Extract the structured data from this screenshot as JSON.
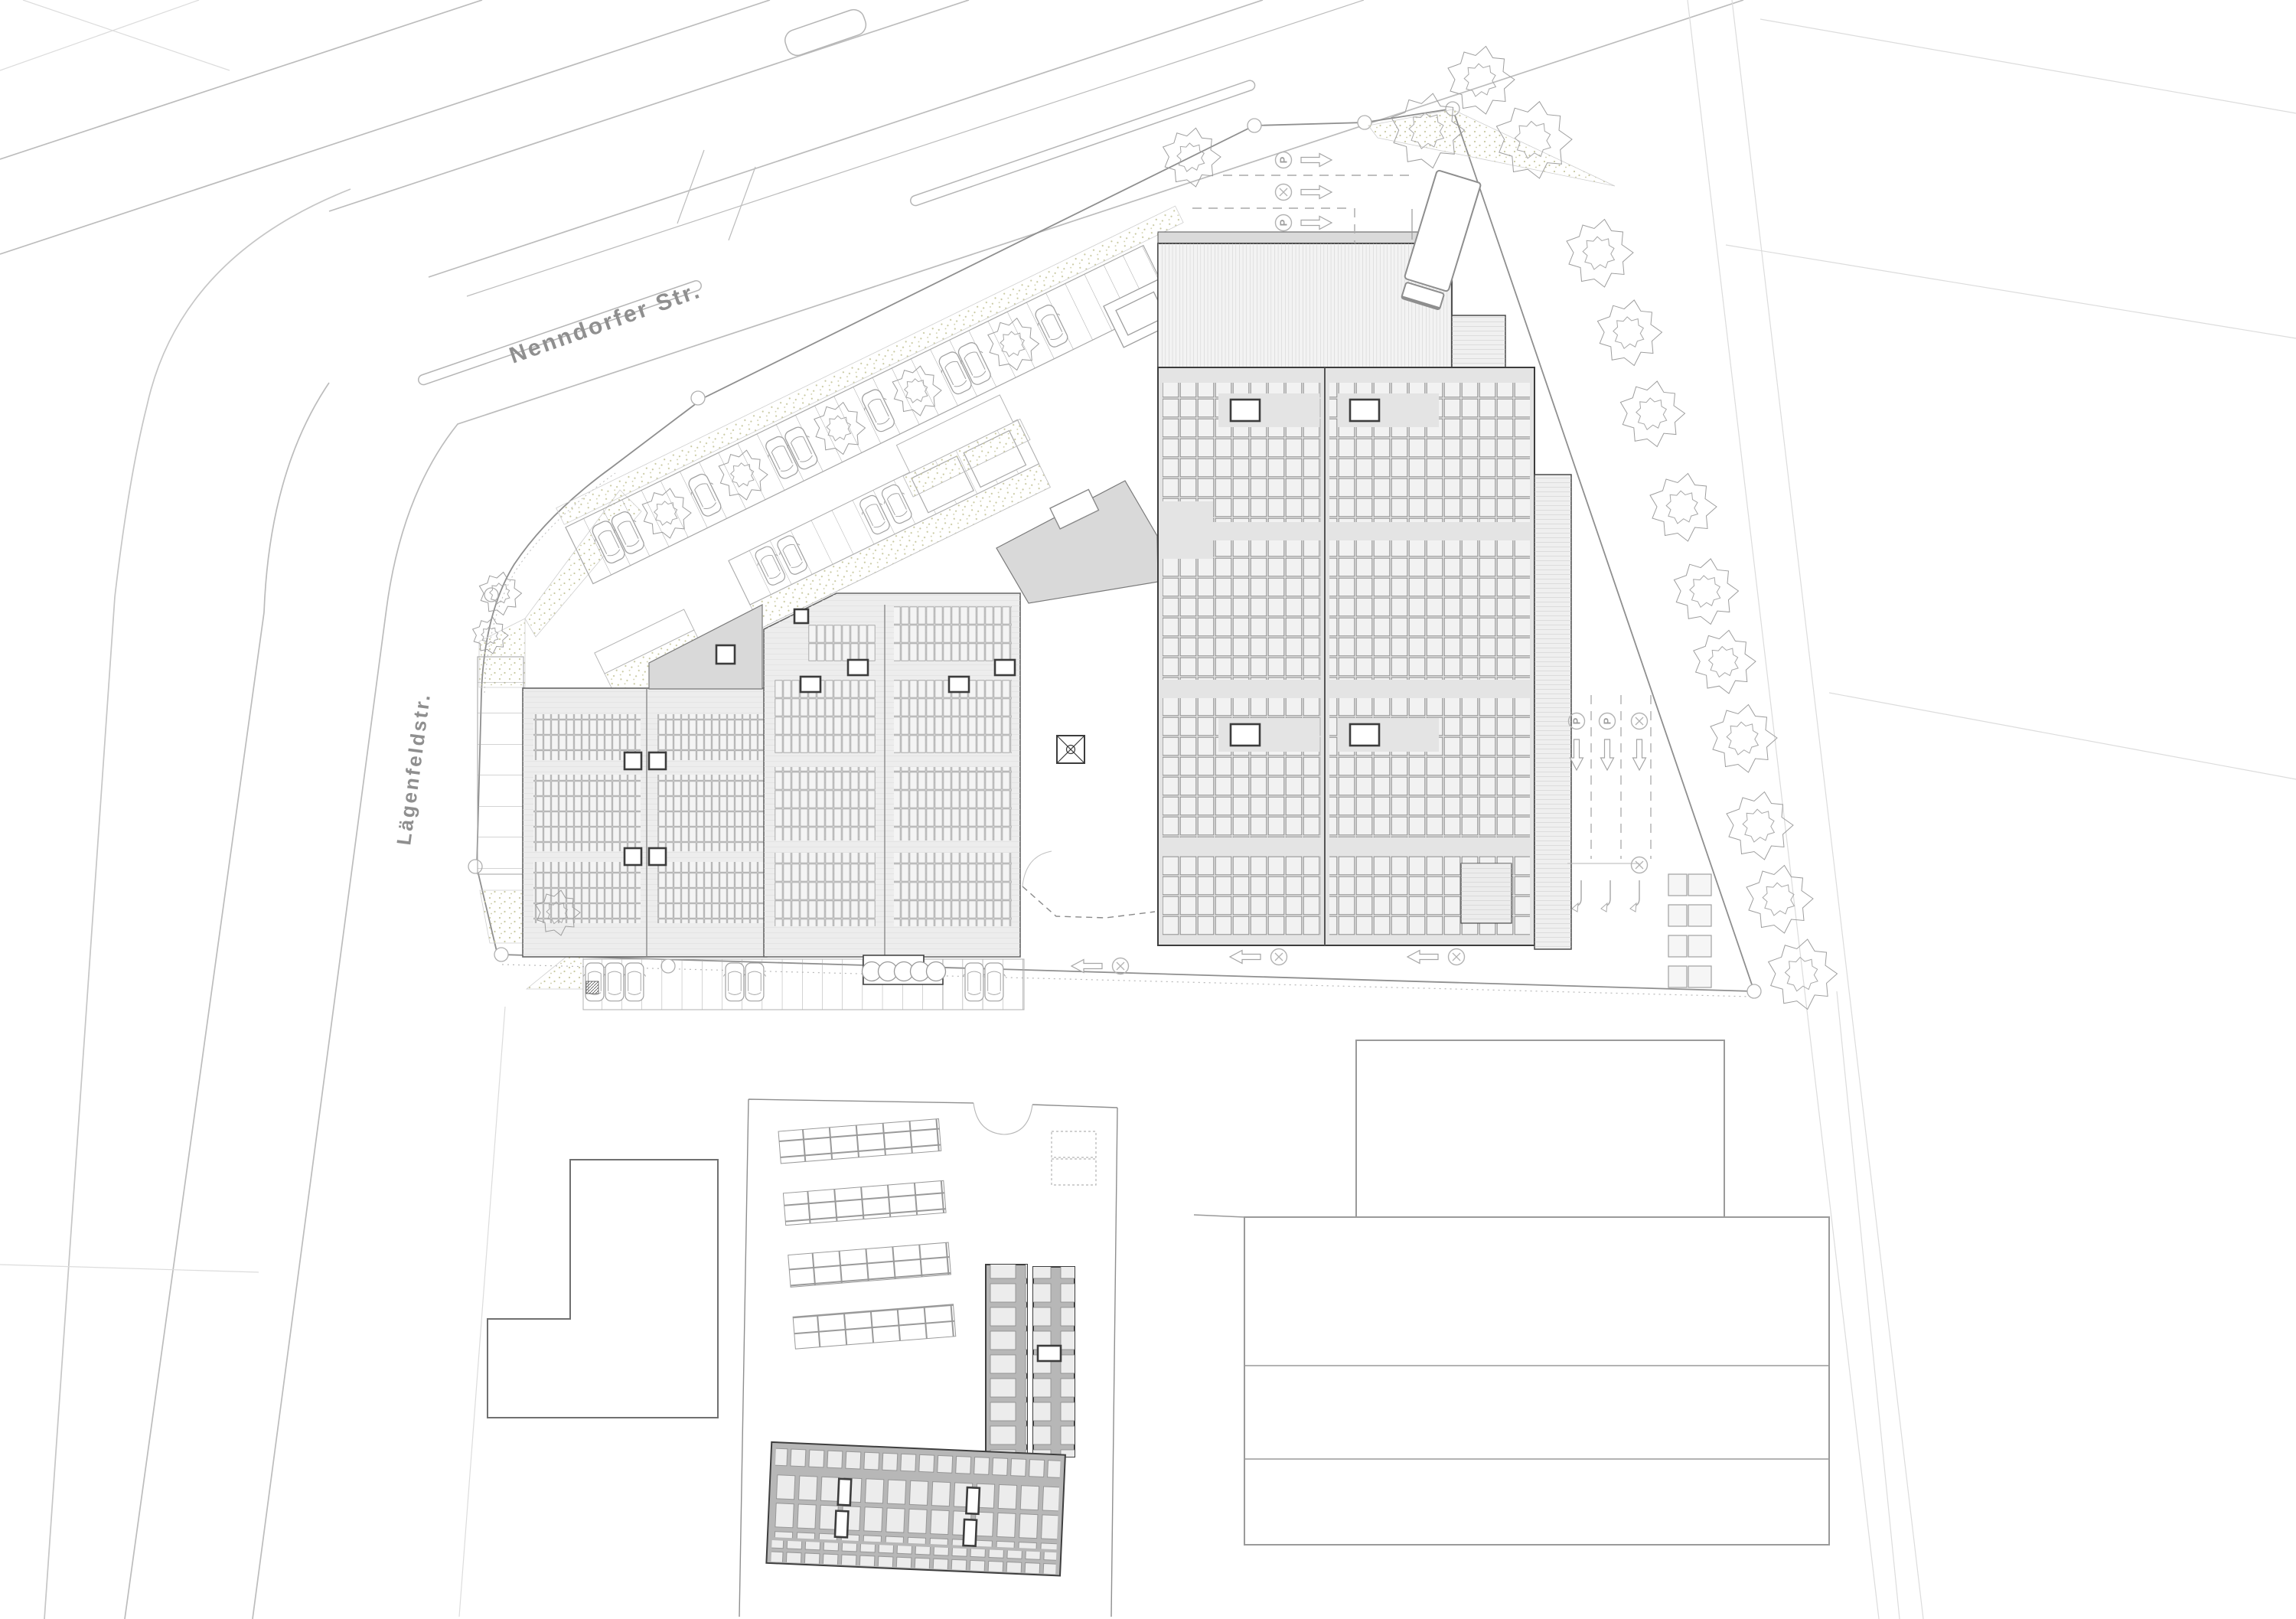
{
  "plan": {
    "streets": [
      {
        "id": "nenndorfer",
        "label": "Nenndorfer Str."
      },
      {
        "id": "laegenfeldstr",
        "label": "Lägenfeldstr."
      }
    ],
    "marking_label": "P",
    "icons": {
      "parking-circle-icon": "circle with P",
      "no-stopping-circle-icon": "circle with diagonal cross",
      "direction-arrow-icon": "outline arrow",
      "turn-arrow-icon": "hooked turn arrow",
      "tree-icon": "deciduous tree scribble",
      "car-icon": "passenger car plan symbol",
      "truck-icon": "truck plan symbol"
    },
    "colors": {
      "paper": "#ffffff",
      "roof_light": "#ededed",
      "roof_mid": "#e4e4e4",
      "canopy": "#d9d9d9",
      "dark_building": "#b7b7b7",
      "panel": "#f2f2f2",
      "stipple_dot": "#c9c9a2",
      "road_line": "#bcbcbc",
      "outline_dark": "#3c3c3c",
      "text_gray": "#8f8f8f"
    }
  }
}
